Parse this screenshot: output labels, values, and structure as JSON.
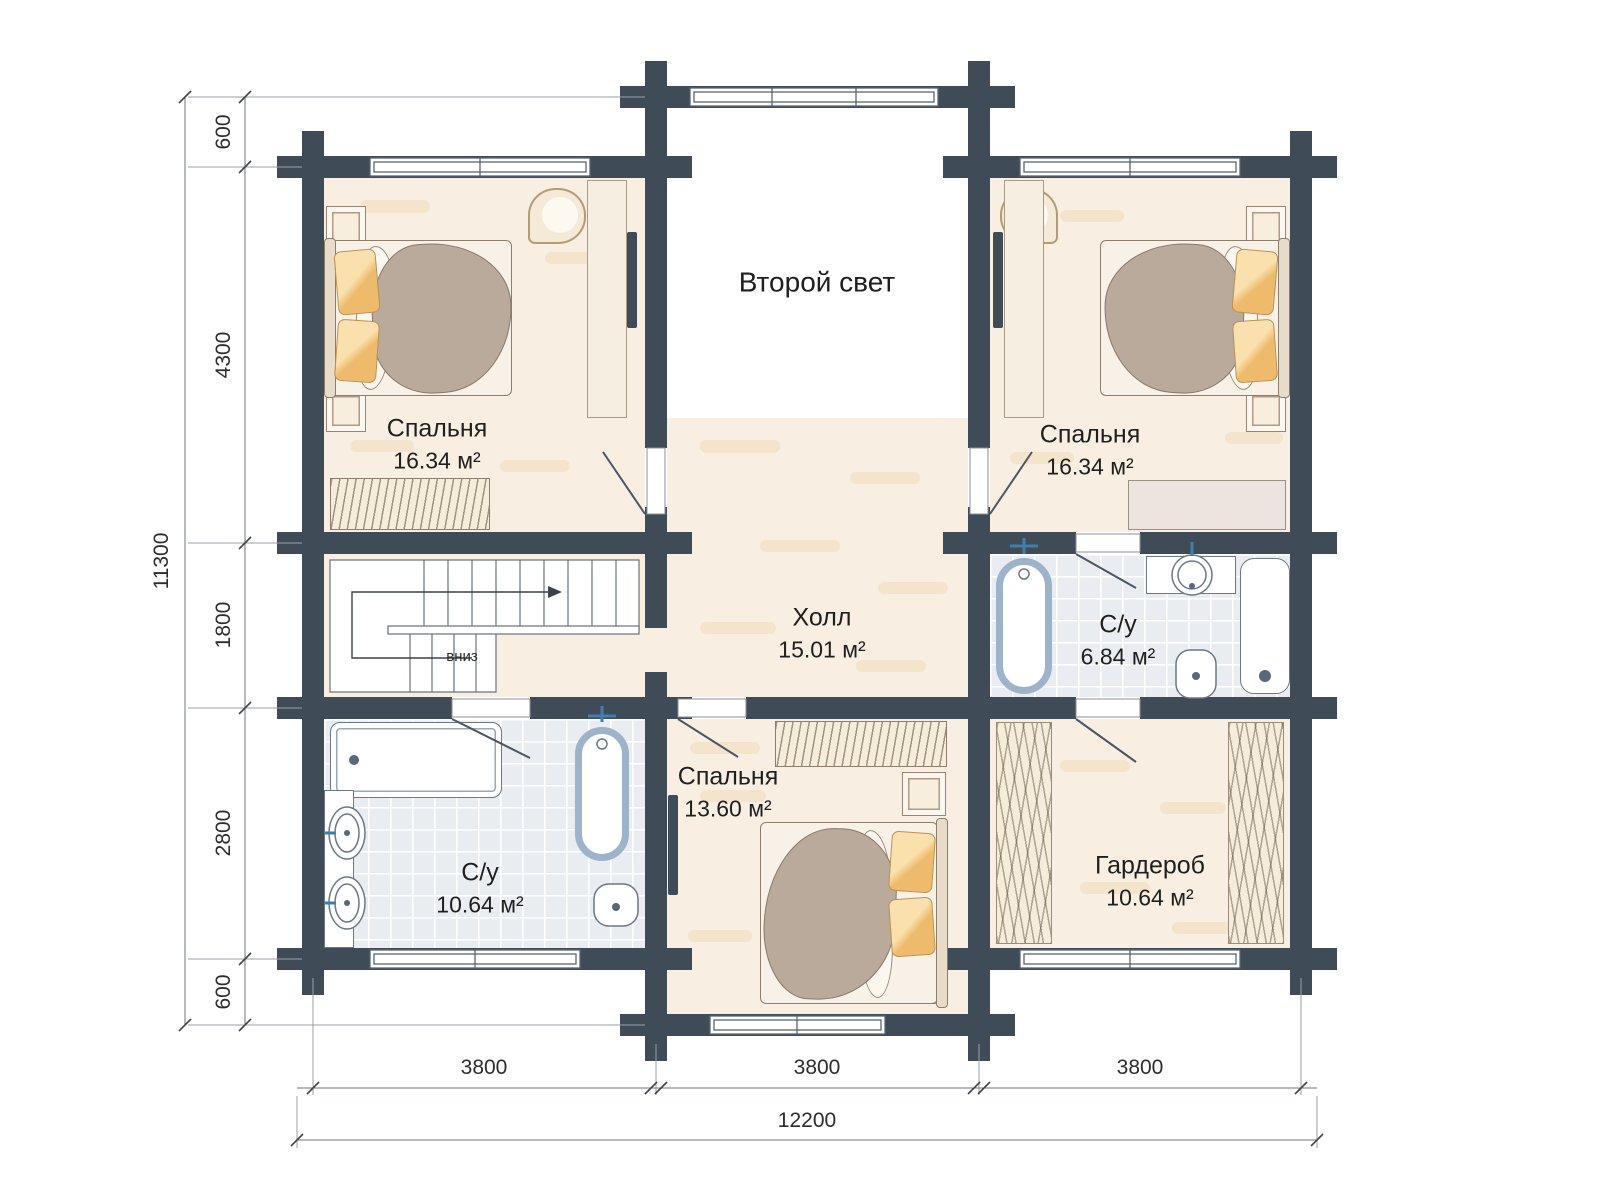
{
  "labels": {
    "void": "Второй свет",
    "stairs_down": "вниз"
  },
  "rooms": [
    {
      "id": "bedroom-top-left",
      "name": "Спальня",
      "area": "16.34 м²"
    },
    {
      "id": "bedroom-top-right",
      "name": "Спальня",
      "area": "16.34 м²"
    },
    {
      "id": "hall",
      "name": "Холл",
      "area": "15.01 м²"
    },
    {
      "id": "bathroom-right",
      "name": "С/у",
      "area": "6.84 м²"
    },
    {
      "id": "bedroom-bottom",
      "name": "Спальня",
      "area": "13.60 м²"
    },
    {
      "id": "bathroom-left",
      "name": "С/у",
      "area": "10.64 м²"
    },
    {
      "id": "wardrobe",
      "name": "Гардероб",
      "area": "10.64 м²"
    }
  ],
  "dimensions": {
    "left_total": "11300",
    "left_chain": [
      "600",
      "4300",
      "1800",
      "2800",
      "600"
    ],
    "bottom_chain": [
      "3800",
      "3800",
      "3800"
    ],
    "bottom_total": "12200"
  },
  "colors": {
    "wall": "#3f4b57",
    "floor": "#f8efe2",
    "tile": "#e9edf2",
    "tub_accent": "#9cb3c9",
    "pillow": "#f3cd8a",
    "blanket": "#b9aa9c",
    "wood_outline": "#8d7d6c"
  }
}
